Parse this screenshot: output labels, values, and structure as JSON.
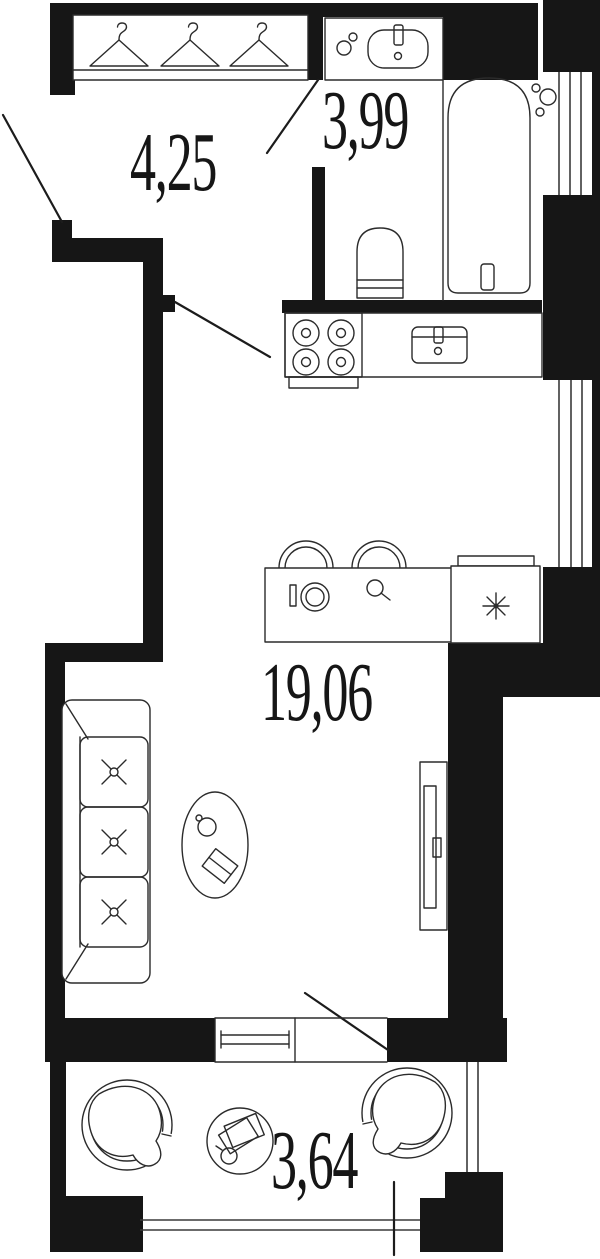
{
  "plan": {
    "type": "apartment-floor-plan",
    "rooms": [
      {
        "id": "hallway",
        "area_label": "4,25"
      },
      {
        "id": "bathroom",
        "area_label": "3,99"
      },
      {
        "id": "living-kitchen",
        "area_label": "19,06"
      },
      {
        "id": "balcony",
        "area_label": "3,64"
      }
    ],
    "fixtures": [
      "wardrobe-with-hangers",
      "vanity-sink",
      "bathtub",
      "toilet",
      "stove-4-burners",
      "kitchen-sink",
      "bar-stools",
      "washing-machine",
      "bar-sink",
      "refrigerator",
      "sofa-3-seat",
      "coffee-table",
      "tv-console",
      "balcony-armchair-left",
      "balcony-armchair-right",
      "balcony-table",
      "window",
      "door-swing-lines",
      "dimension-tick"
    ],
    "icons": {
      "refrigerator": "✳",
      "hanger": "⧍"
    },
    "colors": {
      "wall": "#161616",
      "line": "#2b2b2b",
      "background": "#ffffff",
      "text": "#161616"
    }
  }
}
